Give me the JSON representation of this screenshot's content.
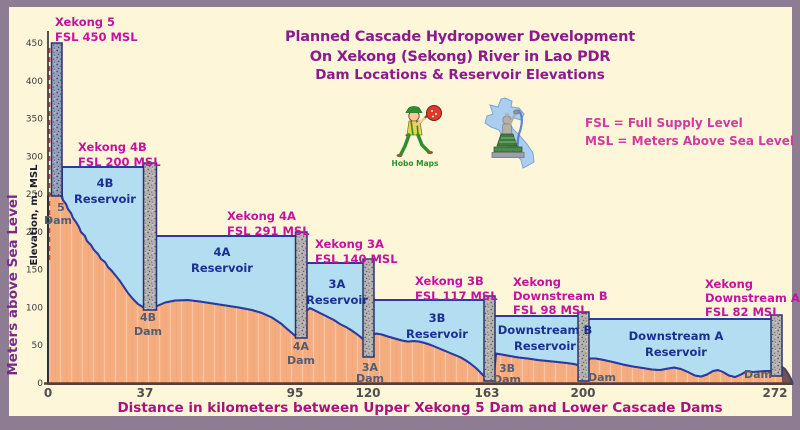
{
  "title": {
    "line1": "Planned Cascade Hydropower Development",
    "line2": "On Xekong (Sekong) River in Lao PDR",
    "line3": "Dam Locations & Reservoir Elevations"
  },
  "legend": {
    "line1": "FSL = Full Supply Level",
    "line2": "MSL = Meters Above Sea Level"
  },
  "y_axis": {
    "title_outer": "Meters above Sea Level",
    "title_inner": "Elevation, m. MSL",
    "ticks": [
      "450",
      "400",
      "350",
      "300",
      "250",
      "200",
      "150",
      "100",
      "50",
      "0"
    ]
  },
  "x_axis": {
    "title": "Distance in kilometers between Upper Xekong 5 Dam and Lower Cascade Dams",
    "ticks": [
      "0",
      "37",
      "95",
      "120",
      "163",
      "200",
      "272"
    ]
  },
  "dams": [
    {
      "name": "Xekong 5",
      "fsl": "FSL 450 MSL",
      "dam1": "5",
      "dam2": "Dam"
    },
    {
      "name": "Xekong 4B",
      "fsl": "FSL 200 MSL",
      "res1": "4B",
      "res2": "Reservoir",
      "dam1": "4B",
      "dam2": "Dam"
    },
    {
      "name": "Xekong 4A",
      "fsl": "FSL 291 MSL",
      "res1": "4A",
      "res2": "Reservoir",
      "dam1": "4A",
      "dam2": "Dam"
    },
    {
      "name": "Xekong 3A",
      "fsl": "FSL 140 MSL",
      "res1": "3A",
      "res2": "Reservoir",
      "dam1": "3A",
      "dam2": "Dam"
    },
    {
      "name": "Xekong 3B",
      "fsl": "FSL 117 MSL",
      "res1": "3B",
      "res2": "Reservoir",
      "dam1": "3B",
      "dam2": "Dam"
    },
    {
      "name": "Xekong",
      "name2": "Downstream B",
      "fsl": "FSL 98 MSL",
      "res1": "Downstream B",
      "res2": "Reservoir",
      "dam1": "Dam"
    },
    {
      "name": "Xekong",
      "name2": "Downstream A",
      "fsl": "FSL 82 MSL",
      "res1": "Downstream A",
      "res2": "Reservoir",
      "dam1": "Dam"
    }
  ],
  "logos": {
    "hobo": "Hobo Maps"
  },
  "colors": {
    "background": "#fdf6d8",
    "frame": "#8e7d92",
    "title_purple": "#8c1a8e",
    "label_magenta": "#c4139e",
    "water_fill": "#b3def2",
    "water_edge": "#2a3aa0",
    "terrain_fill": "#f5ad80",
    "terrain_edge": "#2c3a8a",
    "dam_marker_red": "#e8392b"
  },
  "chart_data": {
    "type": "area",
    "title": "Planned Cascade Hydropower Development On Xekong (Sekong) River in Lao PDR — Dam Locations & Reservoir Elevations",
    "xlabel": "Distance in kilometers between Upper Xekong 5 Dam and Lower Cascade Dams",
    "ylabel": "Elevation, m. MSL (Meters above Sea Level)",
    "xlim": [
      0,
      272
    ],
    "ylim": [
      0,
      450
    ],
    "x_ticks": [
      0,
      37,
      95,
      120,
      163,
      200,
      272
    ],
    "y_ticks": [
      0,
      50,
      100,
      150,
      200,
      250,
      300,
      350,
      400,
      450
    ],
    "legend_position": "right",
    "grid": false,
    "dams": [
      {
        "name": "Xekong 5",
        "distance_km": 0,
        "fsl_msl": 450,
        "reservoir": null
      },
      {
        "name": "Xekong 4B",
        "distance_km": 37,
        "fsl_msl": 200,
        "reservoir": "4B Reservoir",
        "drawn_surface_msl": 285
      },
      {
        "name": "Xekong 4A",
        "distance_km": 95,
        "fsl_msl": 291,
        "reservoir": "4A Reservoir",
        "drawn_surface_msl": 192
      },
      {
        "name": "Xekong 3A",
        "distance_km": 120,
        "fsl_msl": 140,
        "reservoir": "3A Reservoir",
        "drawn_surface_msl": 158
      },
      {
        "name": "Xekong 3B",
        "distance_km": 163,
        "fsl_msl": 117,
        "reservoir": "3B Reservoir",
        "drawn_surface_msl": 110
      },
      {
        "name": "Xekong Downstream B",
        "distance_km": 200,
        "fsl_msl": 98,
        "reservoir": "Downstream B Reservoir",
        "drawn_surface_msl": 89
      },
      {
        "name": "Xekong Downstream A",
        "distance_km": 272,
        "fsl_msl": 82,
        "reservoir": "Downstream A Reservoir",
        "drawn_surface_msl": 85
      }
    ],
    "notes": "FSL = Full Supply Level; MSL = Meters Above Sea Level"
  }
}
